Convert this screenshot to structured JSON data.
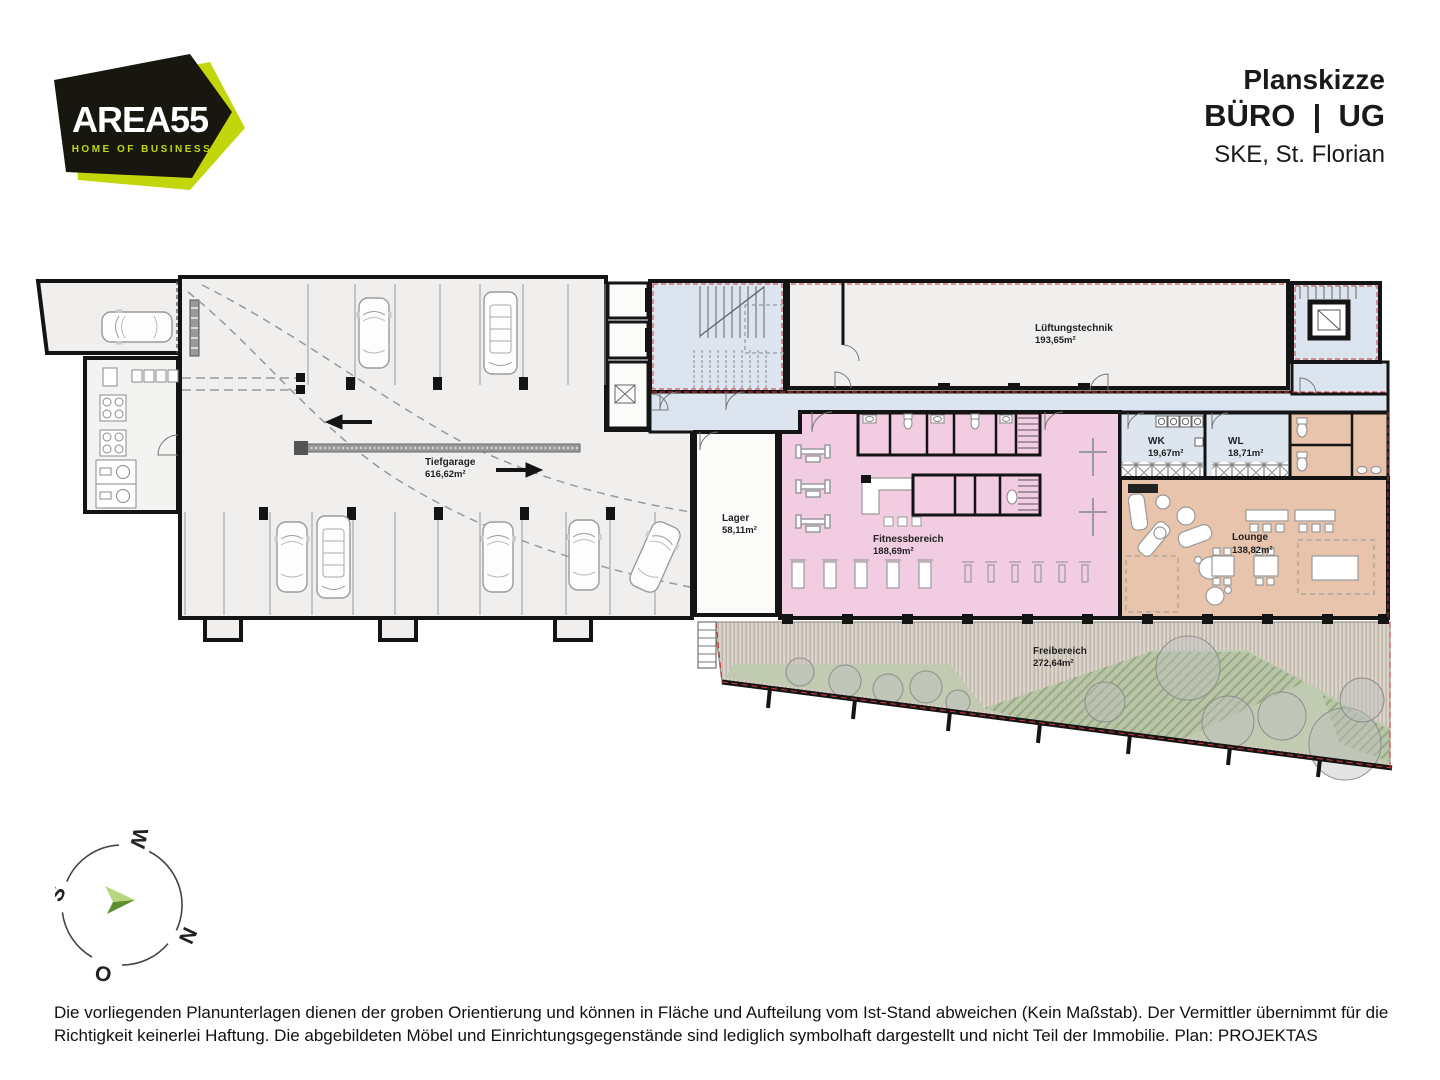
{
  "header": {
    "logo": {
      "brand": "AREA55",
      "tagline": "HOME OF BUSINESS",
      "accent_color": "#c3d60b",
      "bg_color": "#17170f"
    },
    "title_line1": "Planskizze",
    "title_line2": "BÜRO  |  UG",
    "title_line3": "SKE, St. Florian"
  },
  "plan": {
    "rooms": [
      {
        "id": "tiefgarage",
        "name": "Tiefgarage",
        "area": "616,62m²",
        "color": "#f0efed"
      },
      {
        "id": "lager",
        "name": "Lager",
        "area": "58,11m²",
        "color": "#fbfbf9"
      },
      {
        "id": "lueftungstechnik",
        "name": "Lüftungstechnik",
        "area": "193,65m²",
        "color": "#f0efed"
      },
      {
        "id": "fitnessbereich",
        "name": "Fitnessbereich",
        "area": "188,69m²",
        "color": "#f2cde2"
      },
      {
        "id": "wk",
        "name": "WK",
        "area": "19,67m²",
        "color": "#dde5ef"
      },
      {
        "id": "wl",
        "name": "WL",
        "area": "18,71m²",
        "color": "#dde5ef"
      },
      {
        "id": "lounge",
        "name": "Lounge",
        "area": "138,82m²",
        "color": "#e9c4ac"
      },
      {
        "id": "freibereich",
        "name": "Freibereich",
        "area": "272,64m²",
        "color": "#d6cfc5"
      }
    ],
    "compass": {
      "top": "W",
      "left": "S",
      "right": "N",
      "bottom": "O"
    }
  },
  "footer": {
    "disclaimer": "Die vorliegenden Planunterlagen dienen der groben Orientierung und können in Fläche und Aufteilung vom Ist-Stand abweichen (Kein Maßstab). Der Vermittler übernimmt für die Richtigkeit keinerlei Haftung. Die abgebildeten Möbel und Einrichtungsgegenstände sind lediglich symbolhaft dargestellt und nicht Teil der Immobilie. Plan: PROJEKTAS"
  }
}
